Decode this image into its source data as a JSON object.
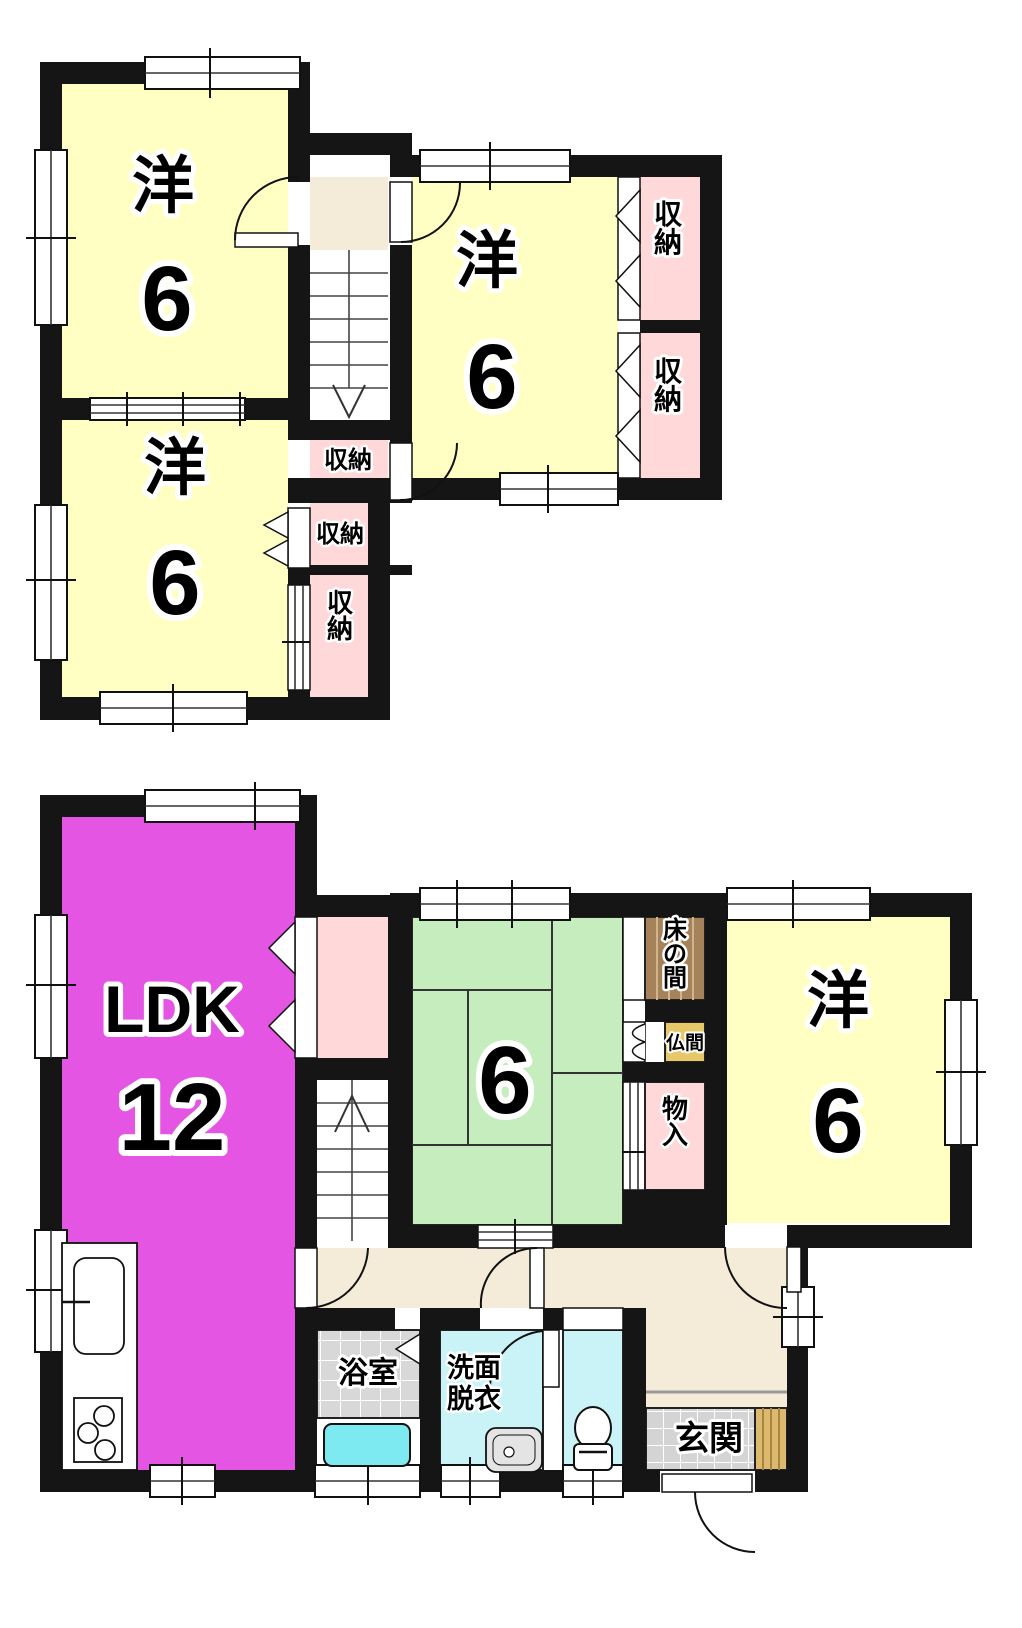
{
  "colors": {
    "wall": "#151515",
    "room_western_yellow": "#ffffc4",
    "storage_pink": "#ffd9d9",
    "ldk_magenta": "#e455e4",
    "tatami_green": "#c6edbd",
    "hall_beige": "#f4ecd9",
    "tokonoma_brown": "#a5825a",
    "butsuma_tan": "#e6c868",
    "wet_room_cyan": "#c9f3f7",
    "bathtub_cyan": "#7de9f0",
    "tile_gray": "#d8d8d8",
    "entry_wood": "#dcb96e"
  },
  "floor2": {
    "room_nw": {
      "type": "洋",
      "size": "6"
    },
    "room_mid": {
      "type": "洋",
      "size": "6"
    },
    "room_sw": {
      "type": "洋",
      "size": "6"
    },
    "closet_right_top": "収納",
    "closet_right_bottom": "収納",
    "closet_mid_top": "収納",
    "closet_mid_middle": "収納",
    "closet_mid_bottom": "収納"
  },
  "floor1": {
    "ldk": {
      "label": "LDK",
      "size": "12"
    },
    "tatami": {
      "size": "6"
    },
    "room_e": {
      "type": "洋",
      "size": "6"
    },
    "tokonoma": "床の間",
    "butsuma": "仏間",
    "storage": "物入",
    "bath": "浴室",
    "washroom_line1": "洗面",
    "washroom_line2": "脱衣",
    "entrance": "玄関"
  }
}
